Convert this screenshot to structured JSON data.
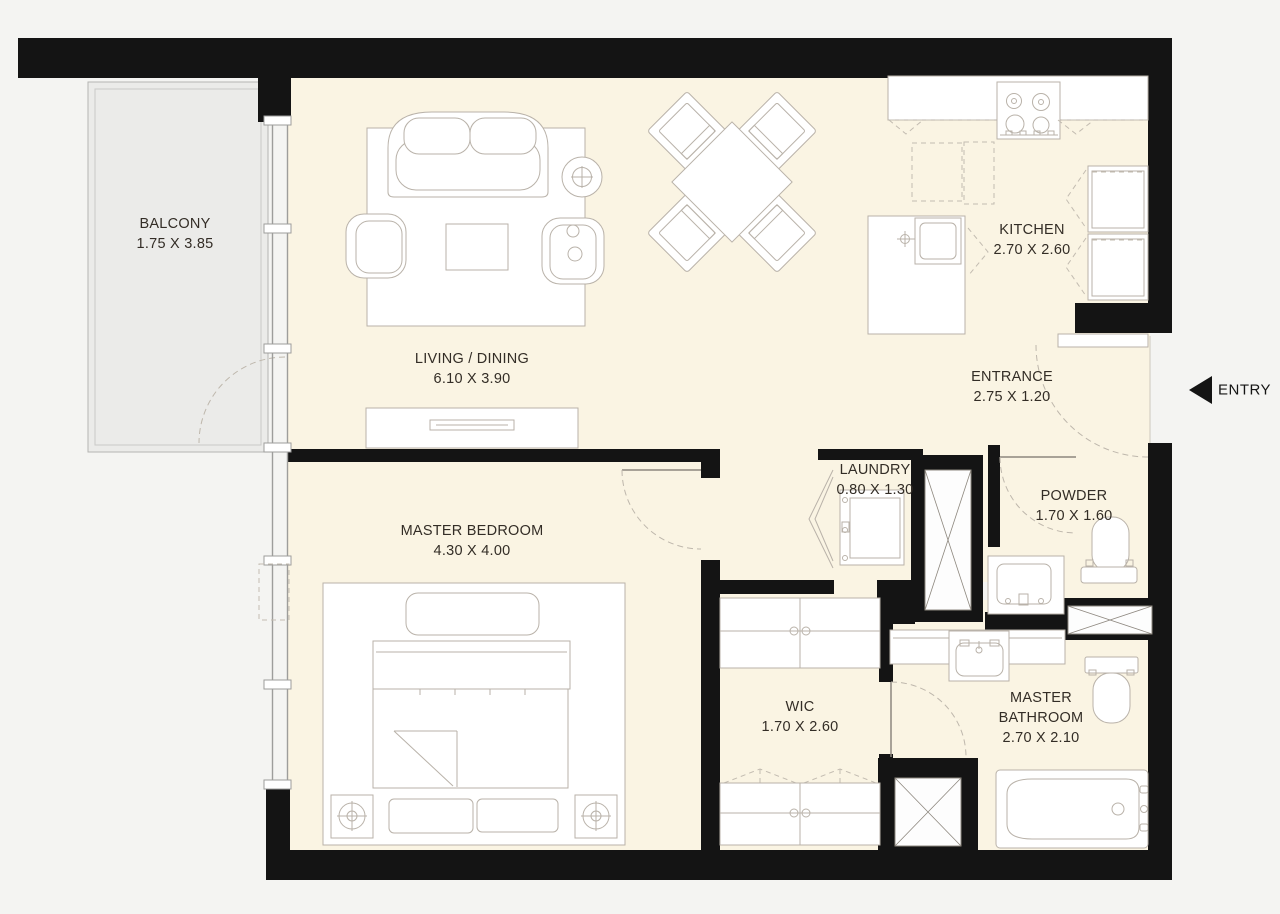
{
  "floor_plan": {
    "title": "One-bedroom apartment floor plan",
    "rooms": [
      {
        "id": "balcony",
        "name": "BALCONY",
        "dimensions": "1.75 X 3.85"
      },
      {
        "id": "living_dining",
        "name": "LIVING / DINING",
        "dimensions": "6.10 X 3.90"
      },
      {
        "id": "kitchen",
        "name": "KITCHEN",
        "dimensions": "2.70 X 2.60"
      },
      {
        "id": "entrance",
        "name": "ENTRANCE",
        "dimensions": "2.75 X 1.20"
      },
      {
        "id": "laundry",
        "name": "LAUNDRY",
        "dimensions": "0.80 X 1.30"
      },
      {
        "id": "powder",
        "name": "POWDER",
        "dimensions": "1.70 X 1.60"
      },
      {
        "id": "master_bedroom",
        "name": "MASTER BEDROOM",
        "dimensions": "4.30 X 4.00"
      },
      {
        "id": "wic",
        "name": "WIC",
        "dimensions": "1.70 X 2.60"
      },
      {
        "id": "master_bathroom",
        "name": "MASTER BATHROOM",
        "dimensions": "2.70 X 2.10"
      }
    ],
    "entry": {
      "label": "ENTRY"
    },
    "colors": {
      "wall": "#141414",
      "floor": "#faf4e3",
      "balcony_floor": "#ebebe9",
      "background": "#f4f4f2",
      "furniture_line": "#b9b2a9"
    }
  }
}
